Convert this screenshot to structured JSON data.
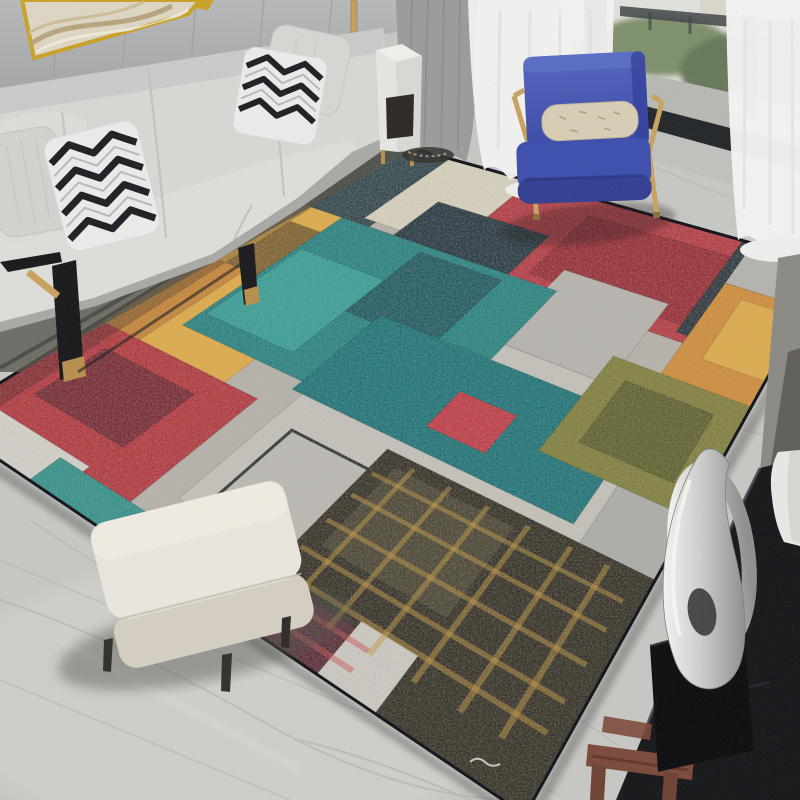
{
  "scene": {
    "description": "modern living room photo: grey sofa with chevron pillows, blue armchair with gold frame, sheer-curtained window, cream ottoman, black console with silver sculpture, large abstract color-block area rug on grey marble floor"
  },
  "palette": {
    "floor": "#c8c9c5",
    "floor_vein": "#b1b2ae",
    "wall": "#b6b8ba",
    "wall_seam": "#9fa1a4",
    "art_canvas": "#ded6c4",
    "art_frame": "#c9a227",
    "sofa": "#d7d7d4",
    "sofa_shade": "#c7c7c4",
    "sofa_shadow": "#57564f",
    "pillow_white": "#ebebe9",
    "pillow_black": "#1e2023",
    "pillow_plain": "#d2d2ce",
    "metal_black": "#19191b",
    "gold": "#c9a25f",
    "gold_dark": "#b98f4e",
    "curtain_grey": "#9b9b99",
    "sheer": "#f2f2f1",
    "window_frame": "#26292c",
    "greenery": "#68795a",
    "balcony_floor": "#b7b9b3",
    "chair_blue": "#3d4fae",
    "chair_blue_dark": "#333f93",
    "chair_pillow": "#d8ceb5",
    "ottoman_top": "#eae6dd",
    "ottoman_front": "#d5cfc2",
    "ottoman_leg": "#332f2a",
    "console": "#17181b",
    "console_grey": "#8b8a85",
    "wood": "#7b4a3b",
    "vase": "#e9e8e4",
    "sculpture_hi": "#f3f3f1",
    "sculpture_lo": "#8f8f8d"
  },
  "rug": {
    "border_color": "#14141a",
    "homography": {
      "a1": 248.8,
      "b1": -427.9,
      "c1": 390,
      "a2": 61.9,
      "b2": 123.4,
      "c2": 142,
      "d": -0.2304,
      "e": -0.368
    },
    "patch_stroke": "rgba(0,0,0,0.14)",
    "gold_scratch_color": "rgba(198,150,58,0.5)",
    "red_scratch_color": "rgba(205,75,75,0.5)",
    "gold_scratch_cols": [
      0.65,
      0.71,
      0.77,
      0.83,
      0.89,
      0.94
    ],
    "gold_scratch_rows": [
      0.76,
      0.8,
      0.845,
      0.89,
      0.925
    ],
    "red_scratch_rows": [
      0.95,
      0.975
    ],
    "patches": [
      {
        "name": "rug-base",
        "u": [
          0,
          1
        ],
        "v": [
          0,
          1
        ],
        "fill": "#b7b3ab"
      },
      {
        "name": "patch-ink-top",
        "u": [
          0,
          0.2
        ],
        "v": [
          0,
          0.36
        ],
        "fill": "#2b4147"
      },
      {
        "name": "patch-teal-left-sliver",
        "u": [
          0,
          0.08
        ],
        "v": [
          0.3,
          0.46
        ],
        "fill": "#20706e"
      },
      {
        "name": "patch-yellow",
        "u": [
          0,
          0.3
        ],
        "v": [
          0.3,
          0.74
        ],
        "fill": "#e5ab3e"
      },
      {
        "name": "patch-yellow-inner-dark",
        "u": [
          0.05,
          0.26
        ],
        "v": [
          0.36,
          0.52
        ],
        "fill": "#7d5f27"
      },
      {
        "name": "patch-yellow-inner-orange",
        "u": [
          0,
          0.1
        ],
        "v": [
          0.52,
          0.74
        ],
        "fill": "#c9822f"
      },
      {
        "name": "patch-yellow-inner-olive",
        "u": [
          0.13,
          0.28
        ],
        "v": [
          0.5,
          0.62
        ],
        "fill": "#8f7430"
      },
      {
        "name": "patch-red-left",
        "u": [
          0,
          0.37
        ],
        "v": [
          0.74,
          0.96
        ],
        "fill": "#b23138"
      },
      {
        "name": "patch-red-left-inner",
        "u": [
          0.07,
          0.28
        ],
        "v": [
          0.78,
          0.9
        ],
        "fill": "#74232d"
      },
      {
        "name": "patch-white-left-corner",
        "u": [
          0.04,
          0.27
        ],
        "v": [
          0.945,
          1
        ],
        "fill": "#d7d5cd"
      },
      {
        "name": "patch-teal-strip-bottom-left",
        "u": [
          0.22,
          0.42
        ],
        "v": [
          0.955,
          1
        ],
        "fill": "#2b8f88"
      },
      {
        "name": "patch-navy-strip-bottom-left",
        "u": [
          0.42,
          0.6
        ],
        "v": [
          0.95,
          1
        ],
        "fill": "#1d2b33"
      },
      {
        "name": "patch-cream-top",
        "u": [
          0.17,
          0.38
        ],
        "v": [
          0,
          0.28
        ],
        "fill": "#dcd5c0"
      },
      {
        "name": "patch-red-top",
        "u": [
          0.38,
          0.86
        ],
        "v": [
          0,
          0.32
        ],
        "fill": "#b5343d"
      },
      {
        "name": "patch-red-top-inner",
        "u": [
          0.55,
          0.84
        ],
        "v": [
          0.06,
          0.28
        ],
        "fill": "#96262f"
      },
      {
        "name": "patch-navy-mid",
        "u": [
          0.26,
          0.52
        ],
        "v": [
          0.16,
          0.36
        ],
        "fill": "#20333d"
      },
      {
        "name": "patch-grey-mid-right",
        "u": [
          0.6,
          0.8
        ],
        "v": [
          0.24,
          0.46
        ],
        "fill": "#b8b5ae"
      },
      {
        "name": "patch-navy-sliver-top-right",
        "u": [
          0.84,
          0.88
        ],
        "v": [
          0,
          0.3
        ],
        "fill": "#242f36"
      },
      {
        "name": "patch-grey-top-right",
        "u": [
          0.86,
          1
        ],
        "v": [
          0,
          0.14
        ],
        "fill": "#b6b4ae"
      },
      {
        "name": "patch-orange-right",
        "u": [
          0.86,
          1
        ],
        "v": [
          0.14,
          0.44
        ],
        "fill": "#d38b30"
      },
      {
        "name": "patch-orange-right-light",
        "u": [
          0.9,
          1
        ],
        "v": [
          0.17,
          0.34
        ],
        "fill": "#e4ab40"
      },
      {
        "name": "patch-grey-band",
        "u": [
          0.42,
          1
        ],
        "v": [
          0.46,
          0.92
        ],
        "fill": "#c7c4bc"
      },
      {
        "name": "patch-square-outline",
        "u": [
          0.46,
          0.72
        ],
        "v": [
          0.76,
          0.9
        ],
        "fill": "#bdbbb3",
        "stroke": "#2b2b28",
        "stroke_width": 3
      },
      {
        "name": "patch-teal-big",
        "u": [
          0.13,
          0.62
        ],
        "v": [
          0.3,
          0.68
        ],
        "fill": "#1f807e"
      },
      {
        "name": "patch-teal-light-inner",
        "u": [
          0.14,
          0.34
        ],
        "v": [
          0.42,
          0.64
        ],
        "fill": "#2f9d95"
      },
      {
        "name": "patch-teal-ink-inner",
        "u": [
          0.34,
          0.52
        ],
        "v": [
          0.32,
          0.52
        ],
        "fill": "#18565c"
      },
      {
        "name": "patch-teal-lower",
        "u": [
          0.4,
          0.88
        ],
        "v": [
          0.5,
          0.7
        ],
        "fill": "#157074"
      },
      {
        "name": "patch-olive-right",
        "u": [
          0.78,
          1
        ],
        "v": [
          0.4,
          0.62
        ],
        "fill": "#7d7c35"
      },
      {
        "name": "patch-olive-inner-dark",
        "u": [
          0.82,
          0.96
        ],
        "v": [
          0.44,
          0.58
        ],
        "fill": "#5c5c27"
      },
      {
        "name": "patch-grey-right-edge",
        "u": [
          0.9,
          1
        ],
        "v": [
          0.62,
          0.82
        ],
        "fill": "#aeaca6"
      },
      {
        "name": "patch-red-sliver-center",
        "u": [
          0.62,
          0.72
        ],
        "v": [
          0.58,
          0.66
        ],
        "fill": "#c23540"
      },
      {
        "name": "patch-black-gold",
        "u": [
          0.6,
          1
        ],
        "v": [
          0.72,
          1
        ],
        "fill": "#2e2a1f"
      },
      {
        "name": "patch-black-gold-inner",
        "u": [
          0.63,
          0.82
        ],
        "v": [
          0.74,
          0.88
        ],
        "fill": "#453f2c"
      },
      {
        "name": "patch-maroon-bottom",
        "u": [
          0.56,
          0.75
        ],
        "v": [
          0.94,
          1
        ],
        "fill": "#542530"
      },
      {
        "name": "patch-white-strip-bottom",
        "u": [
          0.74,
          0.82
        ],
        "v": [
          0.93,
          1
        ],
        "fill": "#cfcdc5"
      }
    ],
    "edge_shadow": {
      "name": "rug-edge-shadow",
      "u": [
        0,
        0.05
      ],
      "v": [
        0,
        1
      ],
      "fill": "rgba(15,15,15,0.28)"
    }
  }
}
